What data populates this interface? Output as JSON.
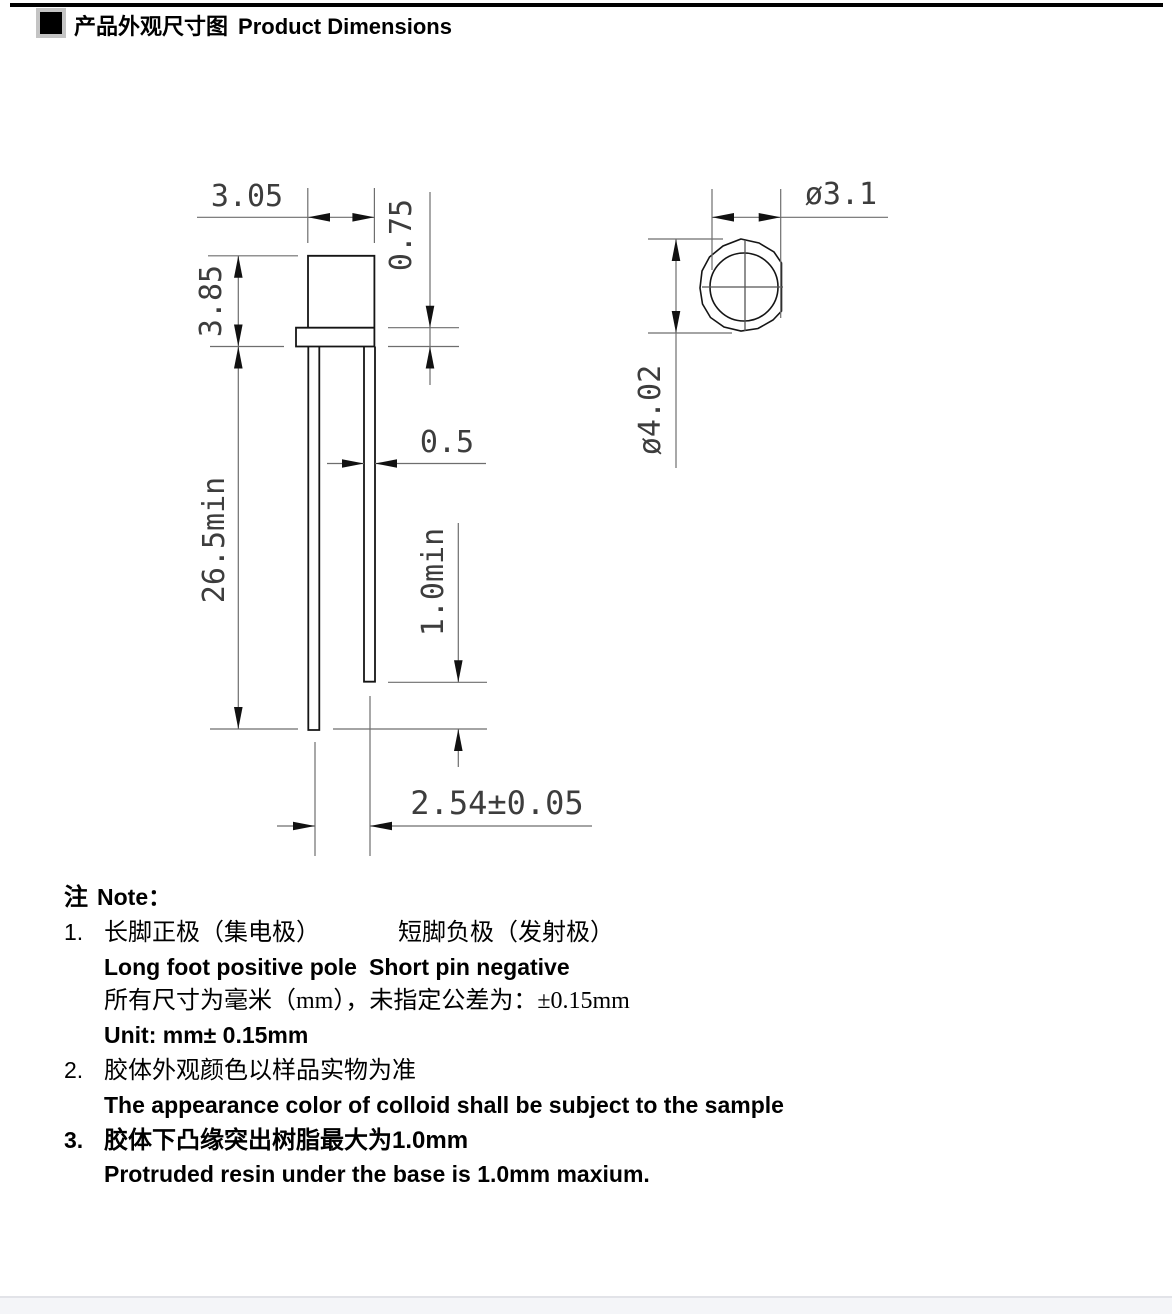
{
  "header": {
    "title_zh": "产品外观尺寸图",
    "title_en": "Product Dimensions"
  },
  "drawing": {
    "front_view": {
      "dim_body_width": "3.05",
      "dim_flange_thickness": "0.75",
      "dim_body_height": "3.85",
      "dim_lead_length": "26.5min",
      "dim_lead_width": "0.5",
      "dim_lead_tip_offset": "1.0min",
      "dim_lead_pitch": "2.54±0.05"
    },
    "top_view": {
      "dim_lens_diameter": "ø3.1",
      "dim_flange_diameter": "ø4.02"
    }
  },
  "notes": {
    "label_zh": "注",
    "label_en": "Note：",
    "item1_num": "1.",
    "item1_zh_a": "长脚正极（集电极）",
    "item1_zh_b": "短脚负极（发射极）",
    "item1_en_a": "Long foot positive pole",
    "item1_en_b": "Short pin negative",
    "item1_unit_zh": "所有尺寸为毫米（mm），未指定公差为：±0.15mm",
    "item1_unit_en": "Unit: mm± 0.15mm",
    "item2_num": "2.",
    "item2_zh": "胶体外观颜色以样品实物为准",
    "item2_en": "The appearance color of colloid shall be subject to the sample",
    "item3_num": "3.",
    "item3_zh": "胶体下凸缘突出树脂最大为1.0mm",
    "item3_en": "Protruded resin under the base is 1.0mm maxium."
  }
}
